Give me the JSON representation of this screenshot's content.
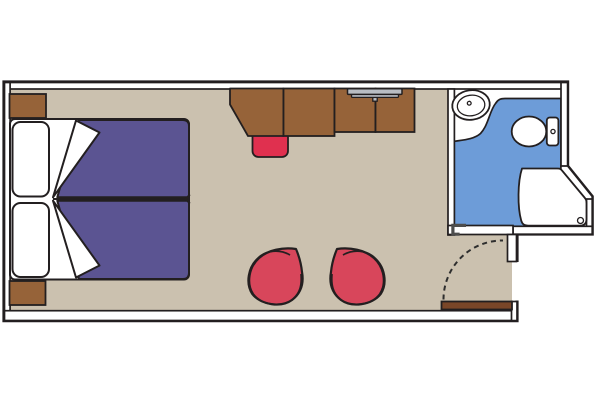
{
  "plan": {
    "name": "cruise-cabin-floor-plan",
    "rooms": [
      "main-cabin",
      "bathroom",
      "entry-vestibule"
    ],
    "furniture": [
      "nightstand-top",
      "nightstand-bottom",
      "double-bed",
      "pillows",
      "desk-unit",
      "tv",
      "stool",
      "tub-chair-left",
      "tub-chair-right",
      "entrance-door"
    ],
    "bathroom_fixtures": [
      "washbasin",
      "toilet",
      "shower"
    ]
  },
  "colors": {
    "background": "#ffffff",
    "wall_fill": "#ffffff",
    "wall_line": "#231f20",
    "floor": "#cbc1af",
    "bathroom_floor": "#6d9cd8",
    "furniture_brown": "#966339",
    "door_brown": "#7a4628",
    "bed_purple": "#5b5492",
    "linen_white": "#ffffff",
    "chair_red": "#d8465b",
    "stool_red": "#e0304f",
    "tv_gray": "#b9bdc3",
    "door_jamb_gray": "#4d4d4d",
    "swing_arc_gray": "#2e2e2e"
  }
}
